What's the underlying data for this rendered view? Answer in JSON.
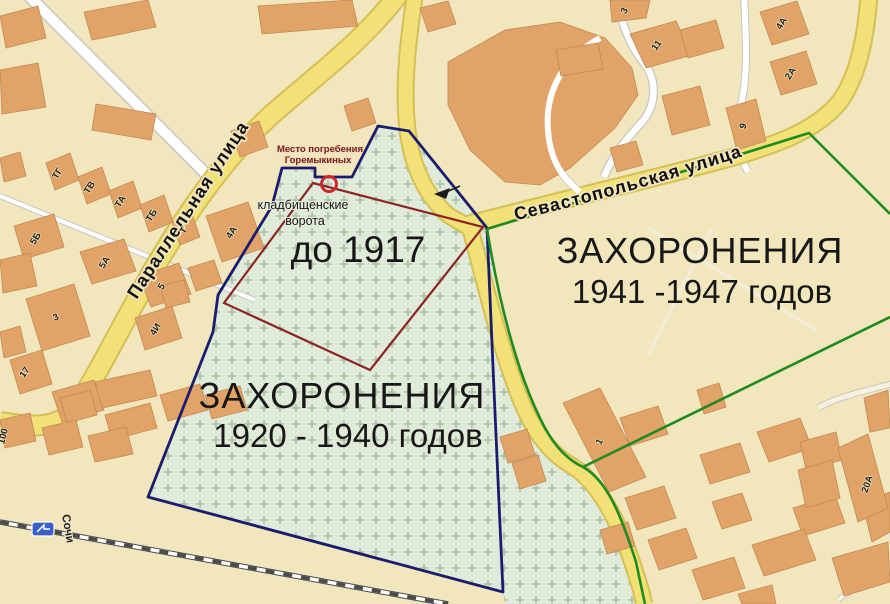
{
  "map": {
    "zones": {
      "pre_1917": {
        "label": "до 1917",
        "color": "#8b2525"
      },
      "burials_1920_1940": {
        "title": "ЗАХОРОНЕНИЯ",
        "subtitle": "1920 - 1940 годов",
        "color": "#1c1c6e"
      },
      "burials_1941_1947": {
        "title": "ЗАХОРОНЕНИЯ",
        "subtitle": "1941 -1947 годов",
        "color": "#1f8a1f"
      }
    },
    "annotations": {
      "goremykin_line1": "Место погребения",
      "goremykin_line2": "Горемыкиных",
      "gates_line1": "кладбищенские",
      "gates_line2": "ворота"
    },
    "streets": {
      "parallelnaya": "Параллельная улица",
      "sevastopolskaya": "Севастопольская улица"
    },
    "railway": {
      "station_label": "Сочи"
    },
    "building_labels": {
      "tg": "ТГ",
      "tv": "ТВ",
      "ta": "ТА",
      "tb": "ТБ",
      "t": "Т",
      "b5b": "5Б",
      "b5a": "5А",
      "b5": "5",
      "b4a": "4А",
      "b3_left": "3",
      "b4i": "4И",
      "b17": "17",
      "b100": "100",
      "b3_top": "3",
      "b11": "11",
      "b4a_ne": "4А",
      "b2a": "2А",
      "b9": "9",
      "b1": "1",
      "b20a": "20А"
    },
    "colors": {
      "cemetery_fill": "#dfead9",
      "zone_pre1917": "#8b2525",
      "zone_1920": "#1c1c6e",
      "zone_1941": "#1f8a1f",
      "gate_marker": "#cc2a2a"
    }
  }
}
